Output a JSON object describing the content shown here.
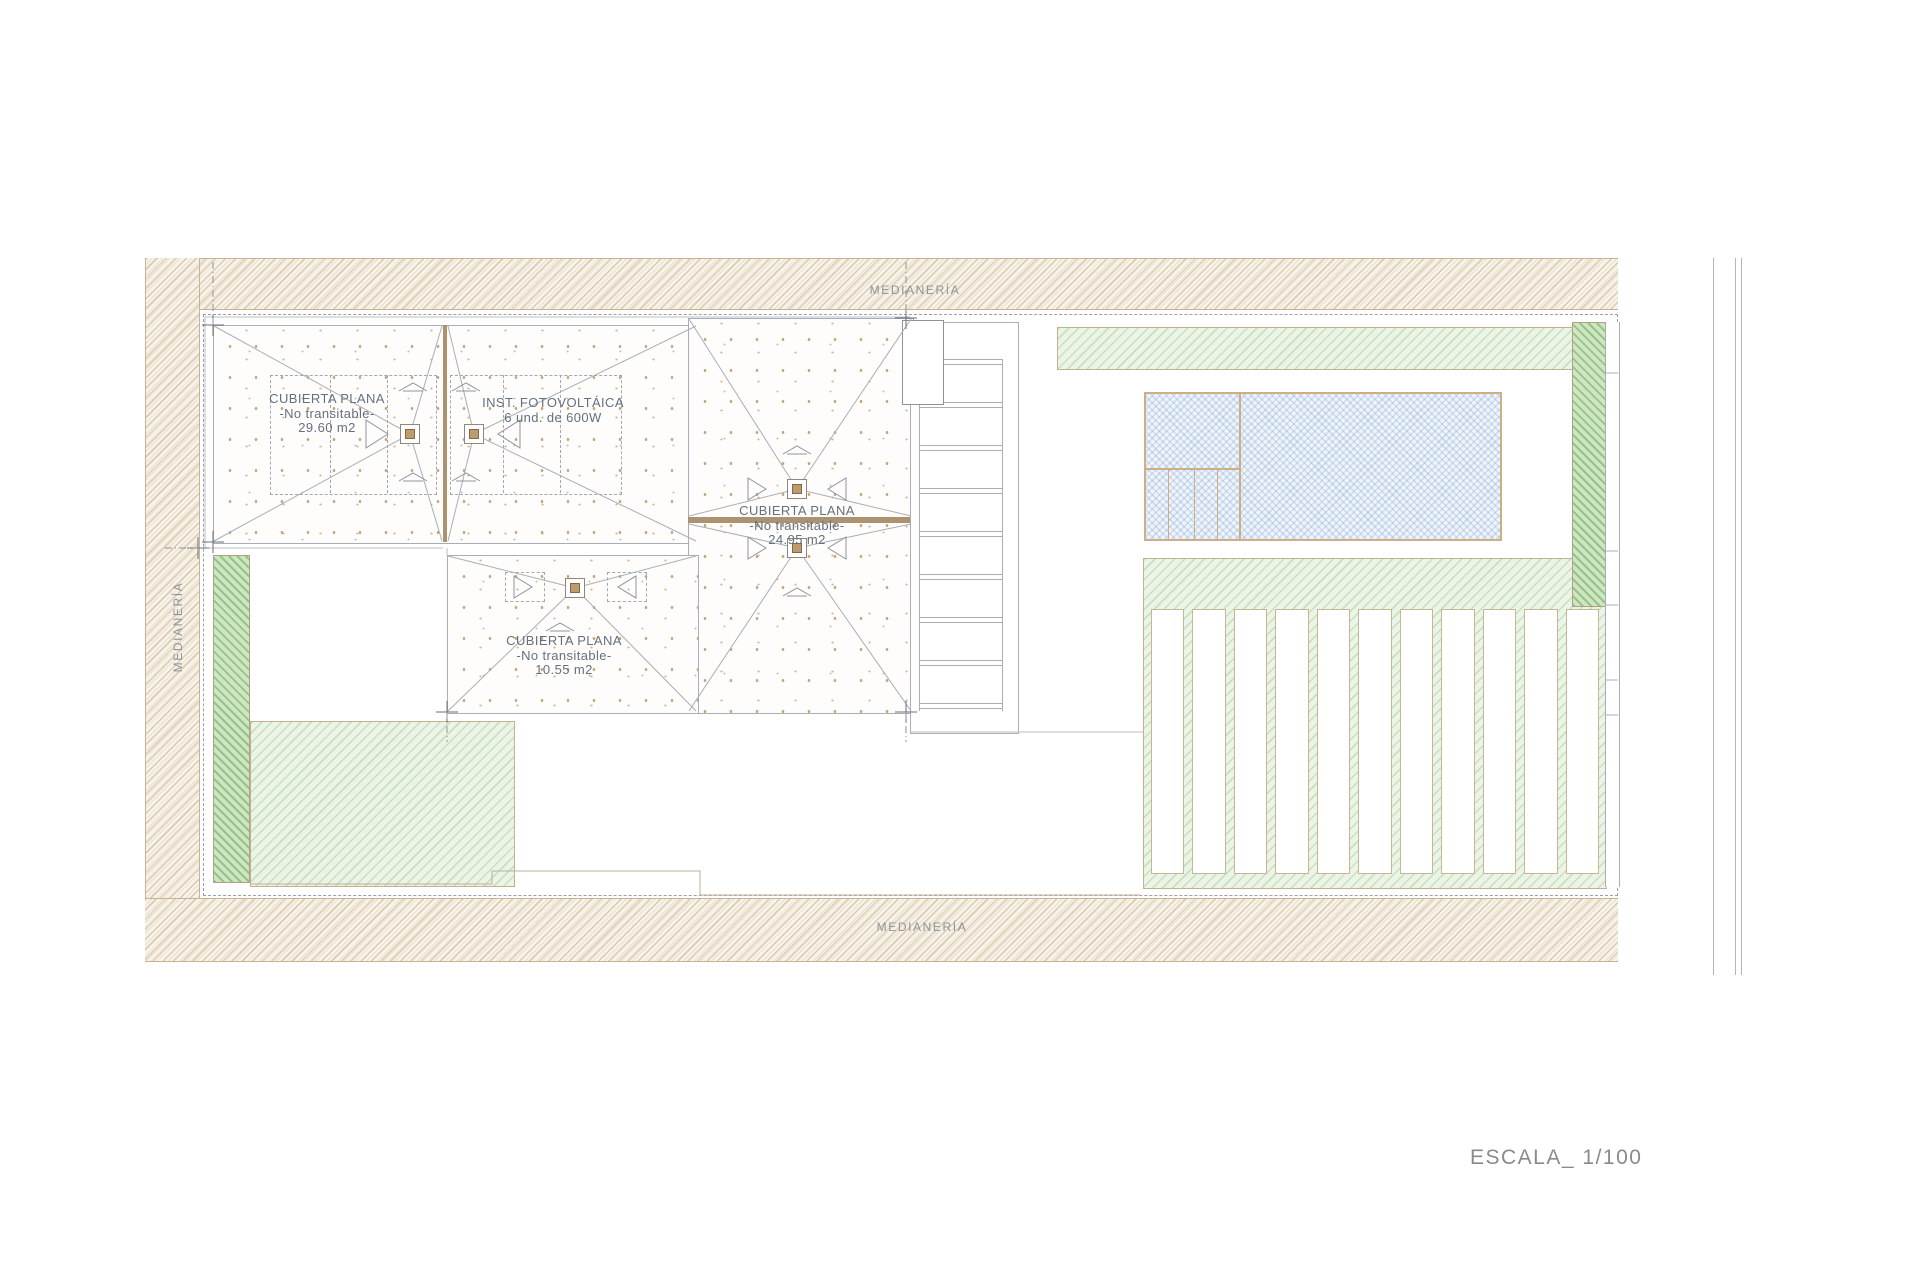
{
  "boundary_labels": {
    "top": "MEDIANERÍA",
    "left": "MEDIANERÍA",
    "bottom": "MEDIANERÍA"
  },
  "roofs": {
    "roof1": {
      "line1": "CUBIERTA PLANA",
      "line2": "-No transitable-",
      "line3": "29.60 m2"
    },
    "pv": {
      "line1": "INST. FOTOVOLTÁICA",
      "line2": "6 und.  de 600W"
    },
    "roof3": {
      "line1": "CUBIERTA PLANA",
      "line2": "-No transitable-",
      "line3": "24.95 m2"
    },
    "roof4": {
      "line1": "CUBIERTA PLANA",
      "line2": "-No transitable-",
      "line3": "10.55 m2"
    }
  },
  "scale_label": "ESCALA_ 1/100",
  "colors": {
    "boundary_hatch_tan": "#d9c6a3",
    "garden_green_light": "#cfe3c6",
    "garden_green_dark": "#a9cf9a",
    "pool_blue": "#dbe7f5",
    "cad_line_gray": "#a9aeb6",
    "label_gray_blue": "#64707f",
    "ridge_brown": "#ab9271",
    "scale_text_gray": "#8a8a8a"
  }
}
